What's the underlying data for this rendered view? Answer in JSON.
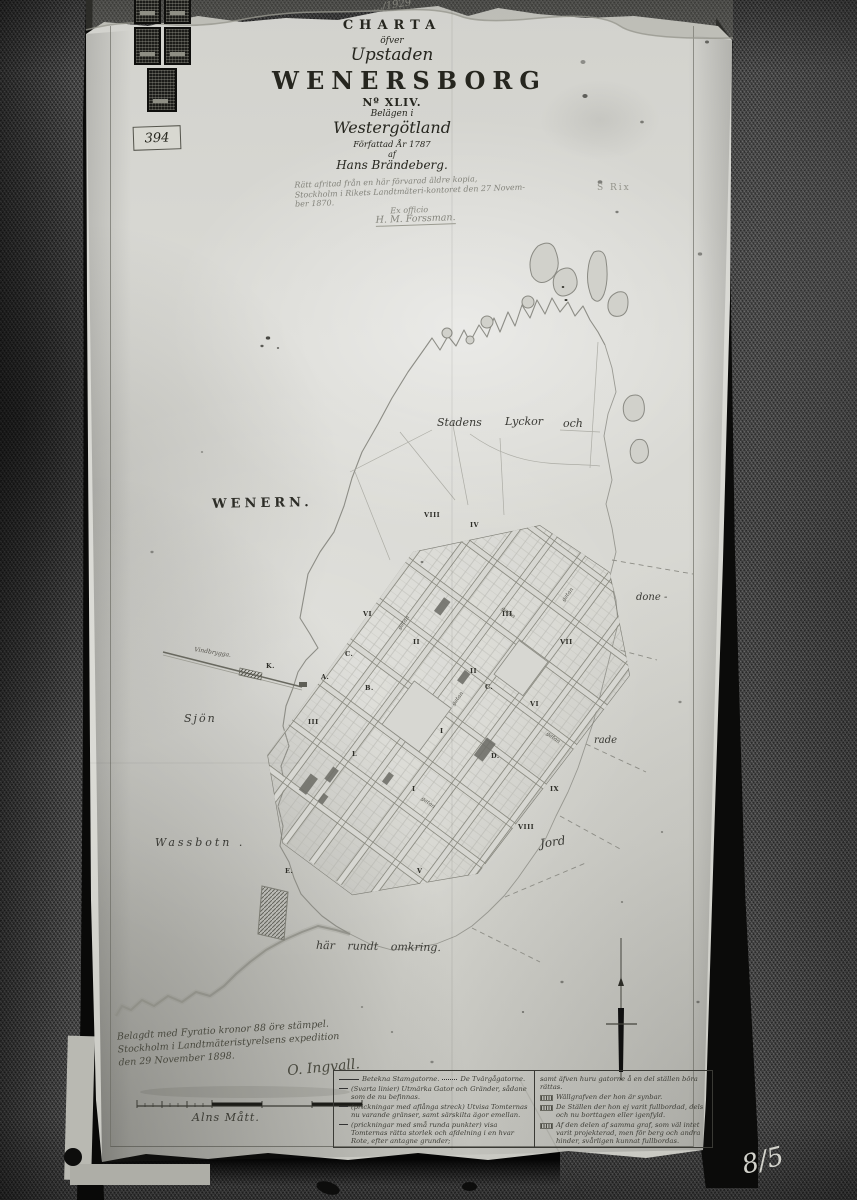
{
  "colors": {
    "paper": "#d7d7d2",
    "fabric": "#3d3d3d",
    "ink": "#2a2a24"
  },
  "photo": {
    "top_note": "…/1929",
    "archive_label": "394",
    "faint_note": "S Rix",
    "corner_note": "8/5"
  },
  "title_block": {
    "charta": "CHARTA",
    "ofver": "öfver",
    "upstaden": "Upstaden",
    "city": "WENERSBORG",
    "number": "Nº XLIV.",
    "belagen": "Belägen i",
    "province": "Westergötland",
    "forfattad": "Författad År 1787",
    "af": "af",
    "author": "Hans Brändeberg.",
    "copy_note": [
      "Rätt afritad från en här förvarad äldre kopia,",
      "Stockholm i Rikets Landtmäteri-kontoret den 27 Novem-",
      "ber 1870.",
      "Ex officio",
      "H. M. Forssman."
    ]
  },
  "map": {
    "wenern": "WENERN.",
    "sjon": "Sjön",
    "wassbotn": "Wassbotn .",
    "stadens": "Stadens",
    "lyckor": "Lyckor",
    "och": "och",
    "done": "done -",
    "rade": "rade",
    "jord": "Jord",
    "har_rundt": "här  rundt  omkring.",
    "brygga": "Vindbrygga.",
    "street_label": "gatan",
    "block_marks": [
      "VIII",
      "IV",
      "VI",
      "III",
      "II",
      "VII",
      "II",
      "C.",
      "VI",
      "I",
      "III",
      "B.",
      "L",
      "D.",
      "I",
      "IX",
      "VIII",
      "V",
      "K.",
      "A.",
      "C.",
      "E."
    ]
  },
  "certification": {
    "lines": [
      "Belagdt med Fyratio kronor 88 öre stämpel.",
      "Stockholm i Landtmäteristyrelsens expedition",
      "den 29 November 1898."
    ],
    "signature": "O. Ingvall.",
    "scale_label": "Alns Mått."
  },
  "legend": {
    "left": [
      "Betekna Stamgatorne.",
      "De Tvärgågatorne.",
      "(Svarta linier) Utmärka Gator och Gränder, sådane som de nu befinnas.",
      "(prickningar med aflånga streck) Utvisa Tomternas nu varande gränser, samt särskilta ägor emellan.",
      "(prickningar med små runda punkter) visa Tomternas rätta storlek och afdelning i en hvar Rote, efter antagne grunder;"
    ],
    "right": [
      "samt äfven huru gatorne å en del ställen böra rättas.",
      "Wällgrafven der hon är synbar.",
      "De Ställen der hon ej varit fullbordad, dels och nu borttagen eller igenfyld.",
      "Af den delen af samma graf, som väl intet varit projekterad, men för berg och andra hinder, svårligen kunnat fullbordas."
    ]
  }
}
